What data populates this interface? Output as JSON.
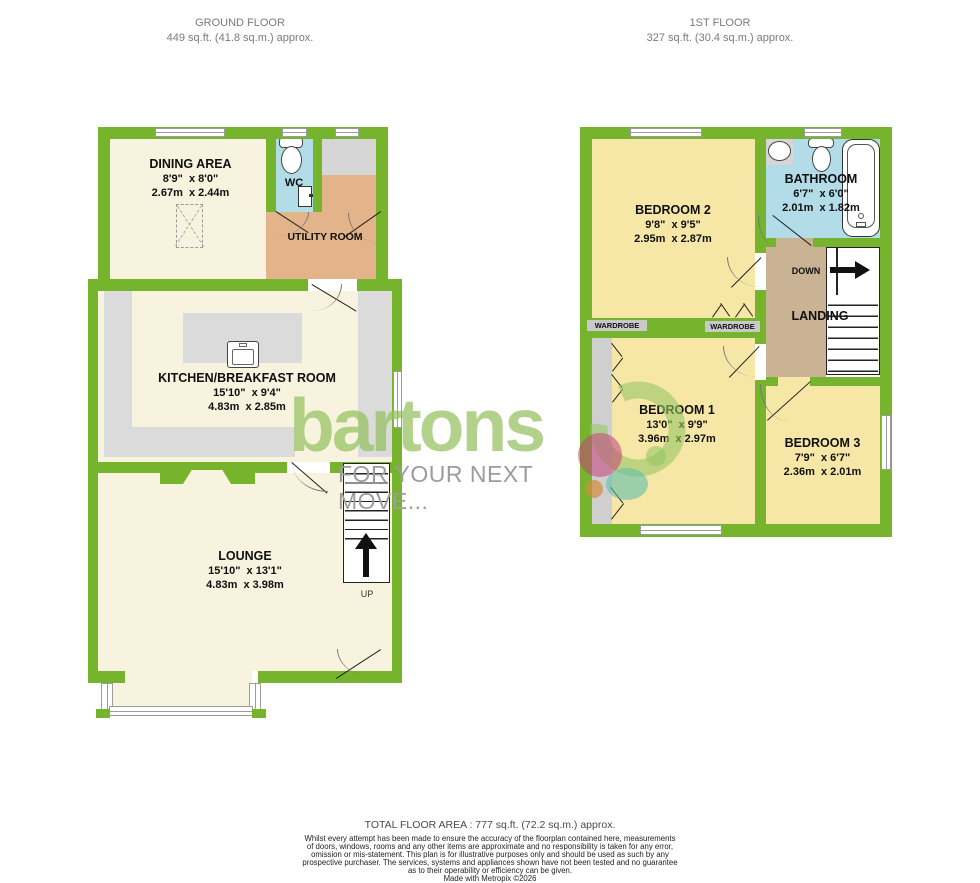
{
  "header": {
    "ground": {
      "title": "GROUND FLOOR",
      "area": "449 sq.ft. (41.8 sq.m.) approx."
    },
    "first": {
      "title": "1ST FLOOR",
      "area": "327 sq.ft. (30.4 sq.m.) approx."
    }
  },
  "ground_floor": {
    "dining": {
      "name": "DINING AREA",
      "imperial": "8'9\"  x 8'0\"",
      "metric": "2.67m  x 2.44m"
    },
    "wc": {
      "name": "WC"
    },
    "utility": {
      "name": "UTILITY ROOM"
    },
    "kitchen": {
      "name": "KITCHEN/BREAKFAST ROOM",
      "imperial": "15'10\"  x 9'4\"",
      "metric": "4.83m  x 2.85m"
    },
    "lounge": {
      "name": "LOUNGE",
      "imperial": "15'10\"  x 13'1\"",
      "metric": "4.83m  x 3.98m"
    },
    "up": "UP"
  },
  "first_floor": {
    "bedroom2": {
      "name": "BEDROOM 2",
      "imperial": "9'8\"  x 9'5\"",
      "metric": "2.95m  x 2.87m"
    },
    "bathroom": {
      "name": "BATHROOM",
      "imperial": "6'7\"  x 6'0\"",
      "metric": "2.01m  x 1.82m"
    },
    "landing": {
      "name": "LANDING",
      "down": "DOWN"
    },
    "wardrobe_left": {
      "name": "WARDROBE"
    },
    "wardrobe_right": {
      "name": "WARDROBE"
    },
    "bedroom1": {
      "name": "BEDROOM 1",
      "imperial": "13'0\"  x 9'9\"",
      "metric": "3.96m  x 2.97m"
    },
    "bedroom3": {
      "name": "BEDROOM 3",
      "imperial": "7'9\"  x 6'7\"",
      "metric": "2.36m  x 2.01m"
    }
  },
  "logo": {
    "brand": "bartons",
    "tagline": "FOR YOUR NEXT MOVE..."
  },
  "footer": {
    "total": "TOTAL FLOOR AREA : 777 sq.ft. (72.2 sq.m.) approx.",
    "disclaimer": [
      "Whilst every attempt has been made to ensure the accuracy of the floorplan contained here, measurements",
      "of doors, windows, rooms and any other items are approximate and no responsibility is taken for any error,",
      "omission or mis-statement. This plan is for illustrative purposes only and should be used as such by any",
      "prospective purchaser. The services, systems and appliances shown have not been tested and no guarantee",
      "as to their operability or efficiency can be given."
    ],
    "credit": "Made with Metropix ©2026"
  },
  "colors": {
    "wall_green": "#76B42E",
    "floor_cream": "#F7F3DE",
    "floor_yellow": "#F7E7A7",
    "floor_blue": "#B2DCE8",
    "floor_utility": "#E3B489",
    "floor_landing": "#C9B394",
    "counter_gray": "#DFDFDF",
    "logo_green": "#8FC45F",
    "tagline_gray": "#9C9C9C"
  }
}
